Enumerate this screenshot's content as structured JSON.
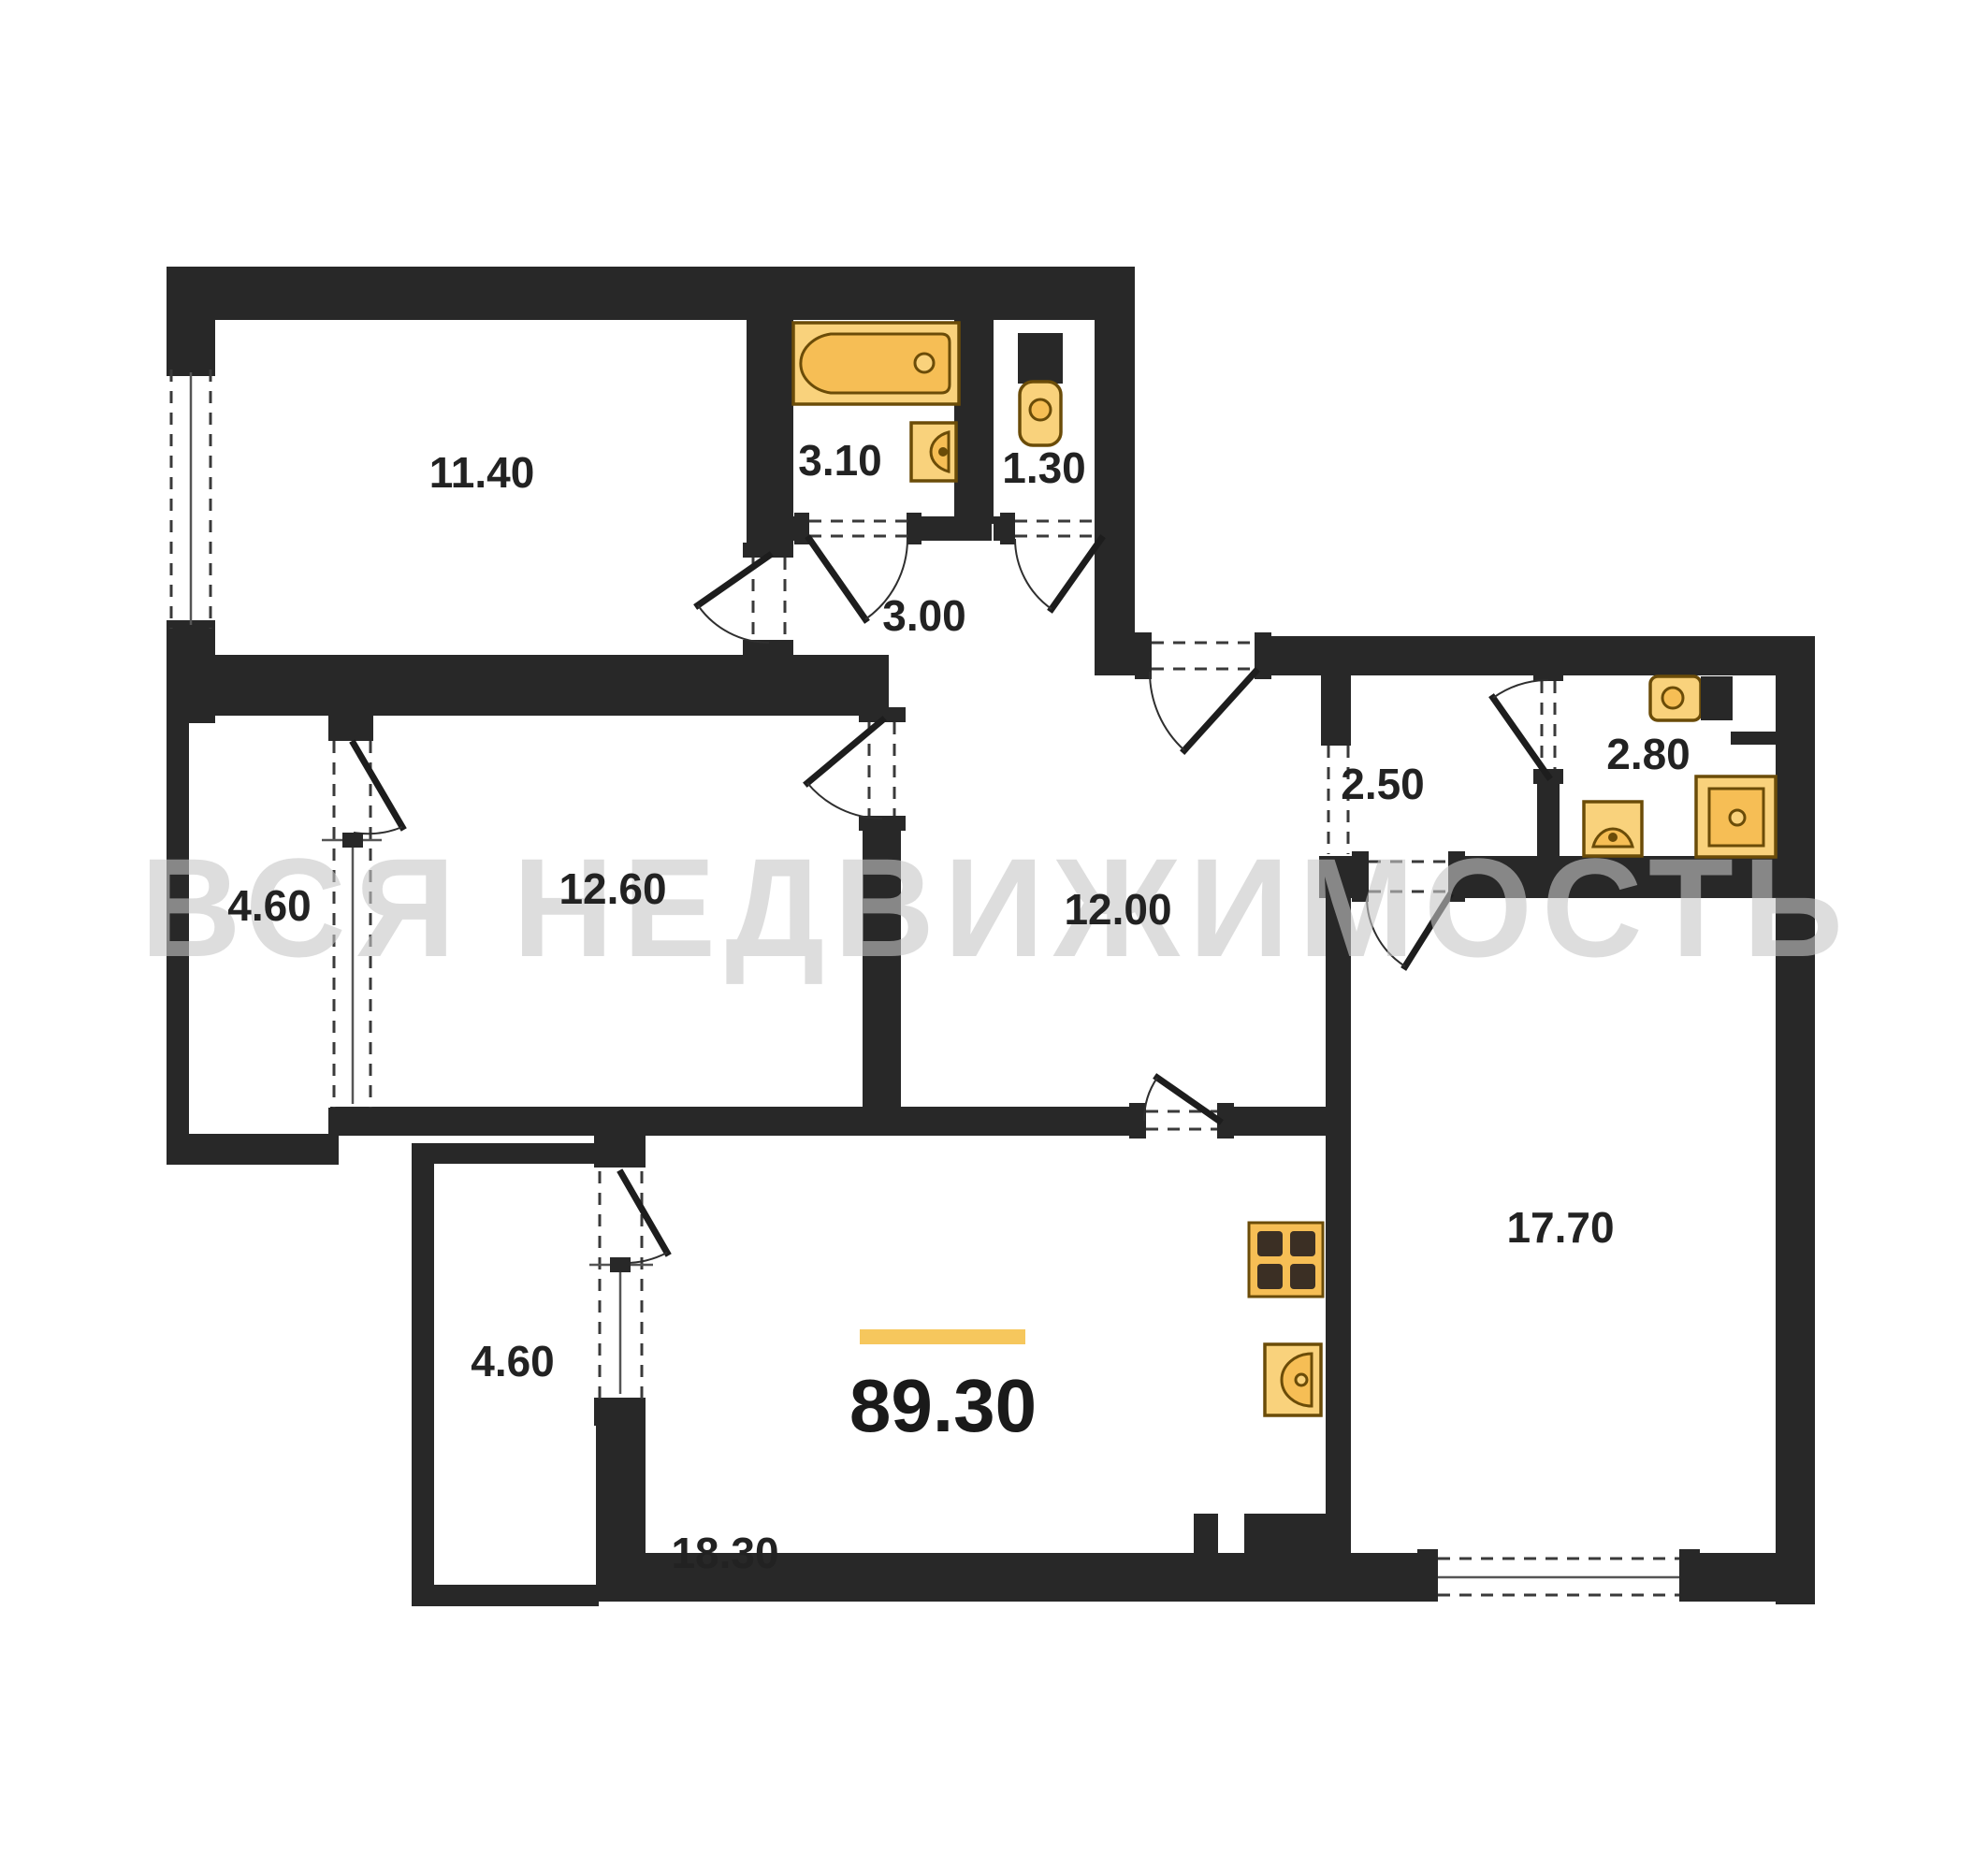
{
  "watermark": {
    "text": "ВСЯ НЕДВИЖИМОСТЬ"
  },
  "total": {
    "value": "89.30"
  },
  "rooms": [
    {
      "name": "bedroom",
      "area": "11.40"
    },
    {
      "name": "bathroom",
      "area": "3.10"
    },
    {
      "name": "wc",
      "area": "1.30"
    },
    {
      "name": "hall",
      "area": "3.00"
    },
    {
      "name": "loggia-upper",
      "area": "4.60"
    },
    {
      "name": "room",
      "area": "12.60"
    },
    {
      "name": "corridor",
      "area": "12.00"
    },
    {
      "name": "entry-hall",
      "area": "2.50"
    },
    {
      "name": "shower-room",
      "area": "2.80"
    },
    {
      "name": "living-room",
      "area": "17.70"
    },
    {
      "name": "loggia-lower",
      "area": "4.60"
    },
    {
      "name": "kitchen-living",
      "area": "18.30"
    }
  ],
  "colors": {
    "wall": "#282828",
    "fixture": "#F6BE55",
    "fixture_light": "#F9D27C",
    "accent_bar": "#F6C75D",
    "watermark": "#c7c7c7"
  }
}
